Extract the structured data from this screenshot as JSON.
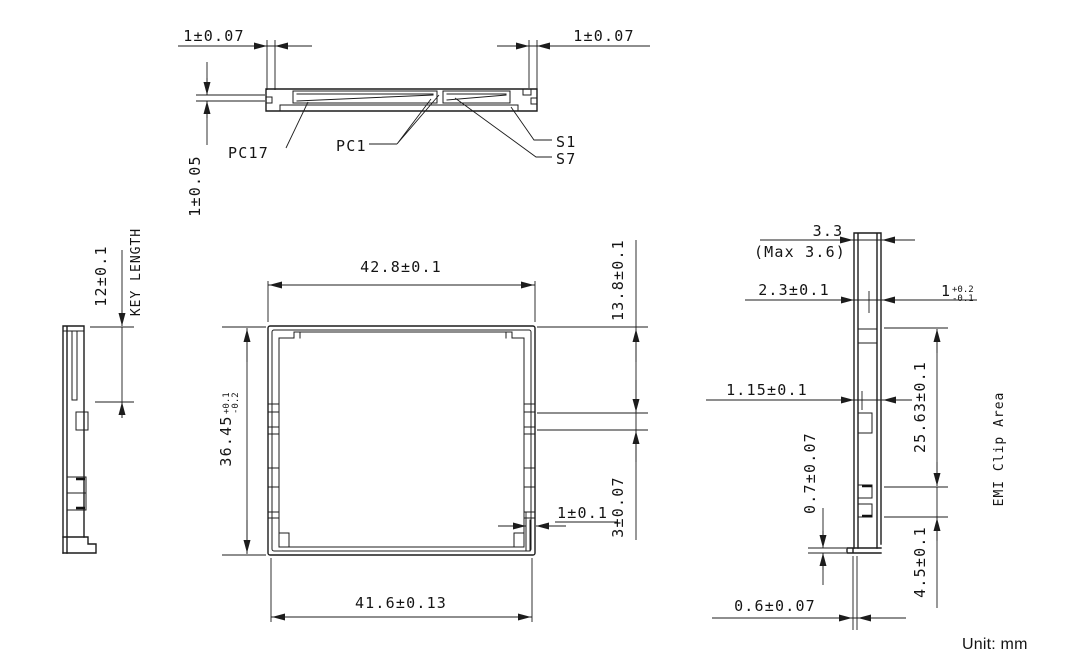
{
  "top_view": {
    "dim_end_left": "1±0.07",
    "dim_end_right": "1±0.07",
    "dim_lip": "1±0.05",
    "label_pc17": "PC17",
    "label_pc1": "PC1",
    "label_s1": "S1",
    "label_s7": "S7"
  },
  "left_view": {
    "dim_key": "12±0.1",
    "key_label": "KEY LENGTH"
  },
  "front_view": {
    "dim_width_top": "42.8±0.1",
    "dim_width_bottom": "41.6±0.13",
    "dim_height": "36.45",
    "dim_height_tol_plus": "+0.1",
    "dim_height_tol_minus": "-0.2",
    "dim_corner": "1±0.1",
    "dim_tab_offset": "13.8±0.1",
    "dim_tab_height": "3±0.07"
  },
  "right_view": {
    "dim_thickness": "3.3",
    "dim_thickness_max": "(Max 3.6)",
    "dim_body": "2.3±0.1",
    "dim_lip": "1",
    "dim_lip_tol_plus": "+0.2",
    "dim_lip_tol_minus": "-0.1",
    "dim_rail": "1.15±0.1",
    "dim_foot": "0.7±0.07",
    "dim_emi_offset": "25.63±0.1",
    "dim_emi_height": "4.5±0.1",
    "emi_label": "EMI Clip Area",
    "dim_bottom_lip": "0.6±0.07"
  },
  "footer": {
    "unit_label": "Unit: mm"
  }
}
